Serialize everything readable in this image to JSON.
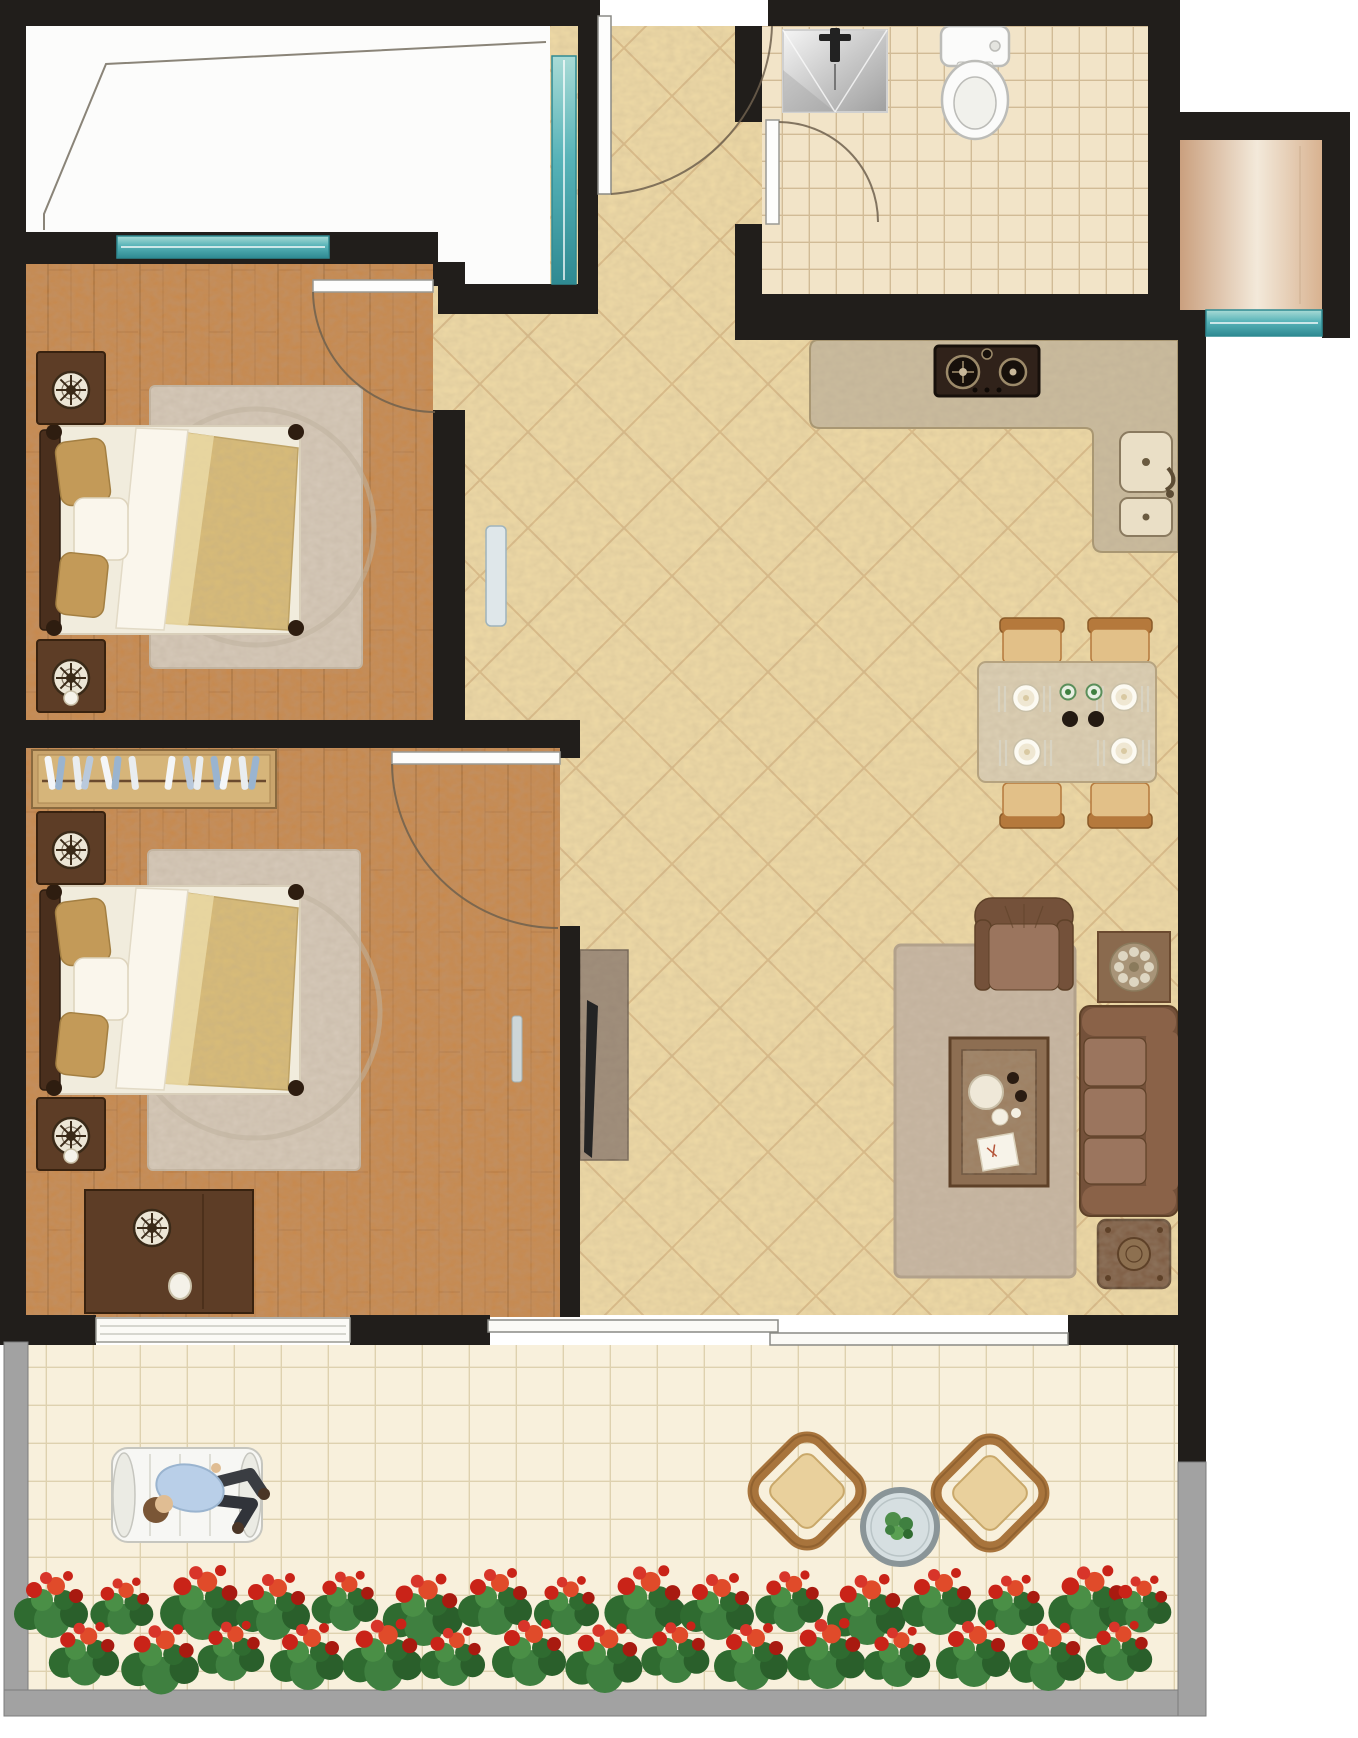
{
  "figure": {
    "kind": "architectural-floor-plan",
    "view": "top-down",
    "text_labels": [],
    "canvas_px": {
      "width": 1358,
      "height": 1738
    }
  },
  "palette": {
    "wall": "#211e1b",
    "tile": "#efdaa6",
    "tile-line": "#c9a06b",
    "wood": "#c8894b",
    "wood-line": "#a96e34",
    "bath-tile": "#f2e4c8",
    "bath-line": "#ccb48d",
    "balc-tile": "#f8f0dc",
    "balc-line": "#dccdaa",
    "teal-dark": "#2f8a92",
    "teal-mid": "#57b3b8",
    "teal-light": "#a9dbd6",
    "rail": "#a2a2a2",
    "rail-dark": "#7c7c7c",
    "bay": "#fcfcfb",
    "bay-line": "#8a8478",
    "counter": "#cbbc9e",
    "counter-line": "#a8966f",
    "door-line": "#6f604e",
    "frame-dark": "#4a2f1d",
    "frame-darker": "#2e1d10",
    "gold": "#c39a58",
    "gold-2": "#d9bc78",
    "gold-3": "#ead9a6",
    "bed-white": "#f1ecdd",
    "bed-white-2": "#faf6ec",
    "nstand": "#5d3d26",
    "nstand-line": "#38220f",
    "rosette-bg": "#ece6d6",
    "rosette-fg": "#3a2a18",
    "wardrobe": "#c9a46c",
    "wardrobe-line": "#8a6a3f",
    "tvpanel": "#9b8977",
    "tvpanel-line": "#6e5f50",
    "tv": "#242424",
    "sofa": "#8a6248",
    "sofa-dark": "#74513a",
    "sofa-cushion": "#9b755e",
    "sofa-line": "#5e4128",
    "rug": "#c9b8a4",
    "rug-line": "#b3a28c",
    "ctable": "#8d6e52",
    "ctable-line": "#5e4128",
    "ctable-in": "#9c7e60",
    "tray": "#efe8d8",
    "cup-dark": "#2a1c12",
    "dtable": "#ddd0b4",
    "dtable-line": "#b7a47e",
    "chair": "#b5793c",
    "chair-line": "#8a5a28",
    "chair-seat": "#e2c088",
    "plate": "#fcfaf2",
    "plate-line": "#c9c0a8",
    "plate-in": "#efe7d2",
    "cutlery": "#d8d3c2",
    "bowl-dark": "#241a12",
    "stove": "#30221a",
    "stove-dark": "#17100b",
    "burner-ring": "#9c8a6a",
    "sink-k": "#eadfc6",
    "sink-k-line": "#8a7a5f",
    "toilet": "#fbfbfa",
    "toilet-line": "#bcbcb8",
    "wicker": "#a8743c",
    "wicker-dark": "#7e5326",
    "wicker-seat": "#e9d09c",
    "gtable-ring": "#8a9598",
    "gtable-glass": "#d6dfe1",
    "chaise": "#f7f7f4",
    "chaise-line": "#c6c6bf",
    "shirt": "#b9cfe8",
    "shirt-line": "#9ab4cf",
    "pants": "#3a3d42",
    "skin": "#e0bd93",
    "hair": "#7a5636",
    "shoe": "#4a3526",
    "green-a": "#2f6b30",
    "green-b": "#3f8040",
    "green-c": "#2a5f2b",
    "green-d": "#4a8f46",
    "red-a": "#c92318",
    "red-b": "#e04b2a",
    "red-c": "#a81a10",
    "red-d": "#d8352a",
    "bench": "#dfe7ea",
    "bench-line": "#9fb4bc"
  },
  "rooms": [
    {
      "name": "bay-window",
      "floor": "white-plate",
      "features": [
        "glazing-outline"
      ]
    },
    {
      "name": "bedroom-1",
      "floor": "wood-plank",
      "furniture": [
        "double-bed",
        "gold-pillows",
        "gold-blanket",
        "round-rug",
        "nightstand-top",
        "nightstand-bottom",
        "rosette-decor",
        "swing-door",
        "window-strip"
      ]
    },
    {
      "name": "bedroom-2",
      "floor": "wood-plank",
      "furniture": [
        "wardrobe-with-hanging-clothes",
        "double-bed",
        "gold-pillows",
        "gold-blanket",
        "round-rug",
        "nightstand-top",
        "nightstand-bottom",
        "dresser-with-jug",
        "swing-door",
        "balcony-window"
      ]
    },
    {
      "name": "bathroom",
      "floor": "small-square-tile",
      "furniture": [
        "metal-washbasin-with-faucet",
        "toilet",
        "swing-door"
      ]
    },
    {
      "name": "kitchen",
      "floor": "diagonal-tile",
      "furniture": [
        "l-shaped-marble-counter",
        "gas-hob-two-burners",
        "double-basin-sink",
        "kettle-faucet"
      ]
    },
    {
      "name": "dining-area",
      "floor": "diagonal-tile",
      "furniture": [
        "rectangular-table",
        "four-chairs",
        "four-place-settings",
        "green-cups",
        "dark-bowls",
        "cutlery"
      ]
    },
    {
      "name": "living-area",
      "floor": "diagonal-tile",
      "furniture": [
        "stone-tv-panel",
        "flat-tv",
        "area-rug",
        "armchair",
        "three-seat-sofa",
        "coffee-table-with-tea-set",
        "side-table-with-flower",
        "patterned-ottoman",
        "hall-bench"
      ]
    },
    {
      "name": "hallway-entry",
      "floor": "diagonal-tile",
      "furniture": [
        "entry-swing-door"
      ]
    },
    {
      "name": "service-niche",
      "floor": "gradient-panel",
      "furniture": [
        "window-strip"
      ]
    },
    {
      "name": "balcony",
      "floor": "grid-tile",
      "furniture": [
        "lounge-chair",
        "reclining-person",
        "two-wicker-chairs",
        "round-glass-table-with-plant",
        "flower-bed-row"
      ]
    }
  ],
  "windows": [
    "bedroom-1-to-bay",
    "bay-side-vertical",
    "service-niche-bottom",
    "bedroom-2-to-balcony"
  ],
  "doors": [
    "entry-top",
    "bedroom-1",
    "bedroom-2",
    "bathroom",
    "balcony-sliding-pair"
  ]
}
